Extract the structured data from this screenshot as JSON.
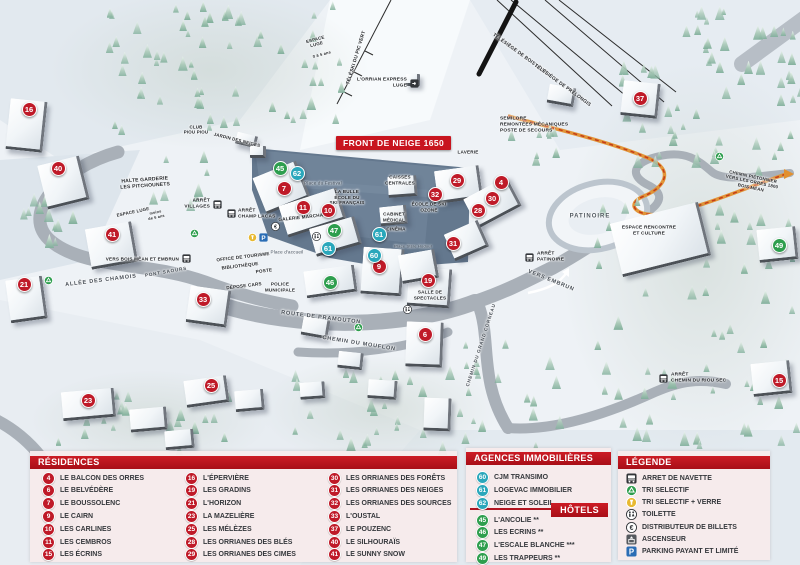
{
  "map": {
    "banner": "FRONT DE NEIGE 1650",
    "markers": [
      {
        "n": "16",
        "c": "r",
        "x": 28,
        "y": 108
      },
      {
        "n": "40",
        "c": "r",
        "x": 57,
        "y": 167
      },
      {
        "n": "41",
        "c": "r",
        "x": 111,
        "y": 233
      },
      {
        "n": "21",
        "c": "r",
        "x": 23,
        "y": 283
      },
      {
        "n": "23",
        "c": "r",
        "x": 87,
        "y": 399
      },
      {
        "n": "25",
        "c": "r",
        "x": 210,
        "y": 384
      },
      {
        "n": "33",
        "c": "r",
        "x": 202,
        "y": 298
      },
      {
        "n": "7",
        "c": "r",
        "x": 283,
        "y": 187
      },
      {
        "n": "11",
        "c": "r",
        "x": 302,
        "y": 206
      },
      {
        "n": "10",
        "c": "r",
        "x": 327,
        "y": 209
      },
      {
        "n": "9",
        "c": "r",
        "x": 378,
        "y": 265
      },
      {
        "n": "19",
        "c": "r",
        "x": 427,
        "y": 279
      },
      {
        "n": "6",
        "c": "r",
        "x": 424,
        "y": 333
      },
      {
        "n": "29",
        "c": "r",
        "x": 456,
        "y": 179
      },
      {
        "n": "32",
        "c": "r",
        "x": 434,
        "y": 193
      },
      {
        "n": "4",
        "c": "r",
        "x": 500,
        "y": 181
      },
      {
        "n": "30",
        "c": "r",
        "x": 491,
        "y": 197
      },
      {
        "n": "28",
        "c": "r",
        "x": 477,
        "y": 209
      },
      {
        "n": "31",
        "c": "r",
        "x": 452,
        "y": 242
      },
      {
        "n": "37",
        "c": "r",
        "x": 639,
        "y": 97
      },
      {
        "n": "15",
        "c": "r",
        "x": 778,
        "y": 379
      },
      {
        "n": "45",
        "c": "g",
        "x": 279,
        "y": 167
      },
      {
        "n": "47",
        "c": "g",
        "x": 333,
        "y": 229
      },
      {
        "n": "46",
        "c": "g",
        "x": 329,
        "y": 281
      },
      {
        "n": "49",
        "c": "g",
        "x": 778,
        "y": 244
      },
      {
        "n": "62",
        "c": "t",
        "x": 296,
        "y": 172
      },
      {
        "n": "61",
        "c": "t",
        "x": 378,
        "y": 233
      },
      {
        "n": "61",
        "c": "t",
        "x": 327,
        "y": 247
      },
      {
        "n": "60",
        "c": "t",
        "x": 373,
        "y": 254
      }
    ],
    "labels": [
      {
        "t": "L'ORRIAN EXPRESS\nLUGE",
        "x": 407,
        "y": 83,
        "al": "r",
        "fs": 4.8
      },
      {
        "t": "TÉLÉSKI DU PIC VERT",
        "x": 357,
        "y": 58,
        "r": -73,
        "fs": 4.8
      },
      {
        "t": "TÉLÉSIÈGE DE BOIS LONG",
        "x": 520,
        "y": 55,
        "r": 36,
        "fs": 4.8
      },
      {
        "t": "TÉLÉSIÈGE DE PRÉLONGIS",
        "x": 562,
        "y": 86,
        "r": 36,
        "fs": 4.8
      },
      {
        "t": "ESPACE\nLUGE",
        "x": 316,
        "y": 42,
        "r": -15,
        "fs": 4.4
      },
      {
        "t": "0 à 5 ans",
        "x": 322,
        "y": 55,
        "r": -15,
        "fs": 4
      },
      {
        "t": "SEMILORE\nREMONTÉES MÉCANIQUES\nPOSTE DE SECOURS",
        "x": 500,
        "y": 125,
        "al": "l",
        "fs": 4.8
      },
      {
        "t": "HALTE GARDERIE\nLES PITCHOUNETS",
        "x": 145,
        "y": 183,
        "r": -4
      },
      {
        "t": "CLUB\nPIOU PIOU",
        "x": 196,
        "y": 130,
        "fs": 4.4
      },
      {
        "t": "JARDIN DES NEIGES",
        "x": 237,
        "y": 140,
        "r": 14,
        "fs": 4.4
      },
      {
        "t": "ESPACE LUGE",
        "x": 133,
        "y": 212,
        "r": -12,
        "fs": 4.4
      },
      {
        "t": "moins\nde 6 ans",
        "x": 156,
        "y": 215,
        "r": -12,
        "fs": 3.8
      },
      {
        "t": "ARRÊT\nVILLAGES",
        "x": 210,
        "y": 204,
        "al": "r",
        "fs": 4.8
      },
      {
        "t": "ARRÊT\nCHAMP LACAS",
        "x": 238,
        "y": 214,
        "al": "l",
        "fs": 4.8
      },
      {
        "t": "Place du Festival",
        "x": 323,
        "y": 183,
        "cls": "place"
      },
      {
        "t": "LA BULLE\nÉCOLE DU\nSKI FRANÇAIS",
        "x": 347,
        "y": 197,
        "fs": 4.6
      },
      {
        "t": "GALERIE MARCHANDE",
        "x": 306,
        "y": 217,
        "r": -6,
        "fs": 4.6
      },
      {
        "t": "CAISSES\nCENTRALES",
        "x": 400,
        "y": 180,
        "fs": 4.6
      },
      {
        "t": "LAVERIE",
        "x": 468,
        "y": 152,
        "fs": 4.6
      },
      {
        "t": "ÉCOLE DE SKI\nOZONE",
        "x": 429,
        "y": 207,
        "fs": 4.6
      },
      {
        "t": "CABINET\nMÉDICAL",
        "x": 394,
        "y": 217,
        "fs": 4.6
      },
      {
        "t": "CINÉMA",
        "x": 396,
        "y": 229,
        "fs": 4.6
      },
      {
        "t": "Place Stèle Hodoul",
        "x": 413,
        "y": 247,
        "cls": "place",
        "fs": 4
      },
      {
        "t": "Place d'accueil",
        "x": 287,
        "y": 252,
        "cls": "place"
      },
      {
        "t": "OFFICE DE TOURISME",
        "x": 243,
        "y": 257,
        "r": -7,
        "fs": 4.6
      },
      {
        "t": "BIBLIOTHÈQUE",
        "x": 240,
        "y": 266,
        "r": -7,
        "fs": 4.6
      },
      {
        "t": "POSTE",
        "x": 264,
        "y": 271,
        "r": -7,
        "fs": 4.6
      },
      {
        "t": "DÉPOSE CARS",
        "x": 244,
        "y": 286,
        "r": -7,
        "fs": 4.6
      },
      {
        "t": "POLICE\nMUNICIPALE",
        "x": 280,
        "y": 287,
        "fs": 4.6
      },
      {
        "t": "ALLÉE DES CHAMOIS",
        "x": 101,
        "y": 281,
        "r": -7,
        "cls": "road"
      },
      {
        "t": "PONT SAOURS",
        "x": 166,
        "y": 272,
        "r": -10,
        "cls": "road",
        "fs": 4.6
      },
      {
        "t": "VERS BOIS MÉAN ET EMBRUN",
        "x": 179,
        "y": 259,
        "al": "r",
        "fs": 4.6
      },
      {
        "t": "ROUTE DE PRAMOUTON",
        "x": 321,
        "y": 318,
        "r": 7,
        "cls": "road"
      },
      {
        "t": "CHEMIN DU MOUFLON",
        "x": 359,
        "y": 344,
        "r": 9,
        "cls": "road"
      },
      {
        "t": "CHEMIN DU GRAND CORNEAU",
        "x": 481,
        "y": 345,
        "r": -72,
        "cls": "road",
        "fs": 4.6
      },
      {
        "t": "VERS EMBRUN",
        "x": 551,
        "y": 281,
        "r": 22,
        "cls": "road"
      },
      {
        "t": "SALLE DE\nSPECTACLES",
        "x": 430,
        "y": 295,
        "fs": 4.6
      },
      {
        "t": "PATINOIRE",
        "x": 590,
        "y": 217,
        "cls": "big"
      },
      {
        "t": "ESPACE RENCONTRE\nET CULTURE",
        "x": 649,
        "y": 231,
        "fs": 4.8
      },
      {
        "t": "ARRÊT\nPATINOIRE",
        "x": 537,
        "y": 257,
        "al": "l",
        "fs": 4.8
      },
      {
        "t": "ARRÊT\nCHEMIN DU RIOU SEC",
        "x": 671,
        "y": 378,
        "al": "l",
        "fs": 4.8
      },
      {
        "t": "CHEMIN PIÉTONNIER\nVERS LES ORRES 1800\nBOIS MÉAN",
        "x": 752,
        "y": 182,
        "r": 12,
        "fs": 4.4
      }
    ],
    "icons": [
      {
        "t": "bus",
        "x": 217,
        "y": 204
      },
      {
        "t": "bus",
        "x": 231,
        "y": 213
      },
      {
        "t": "bus",
        "x": 186,
        "y": 258
      },
      {
        "t": "bus",
        "x": 529,
        "y": 257
      },
      {
        "t": "bus",
        "x": 663,
        "y": 378
      },
      {
        "t": "recycle",
        "x": 194,
        "y": 233
      },
      {
        "t": "recycle",
        "x": 48,
        "y": 280
      },
      {
        "t": "recycle",
        "x": 358,
        "y": 327
      },
      {
        "t": "recycle",
        "x": 719,
        "y": 156
      },
      {
        "t": "glass",
        "x": 252,
        "y": 237
      },
      {
        "t": "parking",
        "x": 263,
        "y": 237
      },
      {
        "t": "euro",
        "x": 275,
        "y": 226
      },
      {
        "t": "toilet",
        "x": 316,
        "y": 236
      },
      {
        "t": "toilet",
        "x": 407,
        "y": 309
      },
      {
        "t": "box",
        "x": 414,
        "y": 83
      }
    ]
  },
  "legend": {
    "residences": {
      "title": "RÉSIDENCES",
      "items": [
        {
          "num": "4",
          "name": "LE BALCON DES ORRES"
        },
        {
          "num": "6",
          "name": "LE BELVÉDÈRE"
        },
        {
          "num": "7",
          "name": "LE BOUSSOLENC"
        },
        {
          "num": "9",
          "name": "LE CAIRN"
        },
        {
          "num": "10",
          "name": "LES CARLINES"
        },
        {
          "num": "11",
          "name": "LES CEMBROS"
        },
        {
          "num": "15",
          "name": "LES ÉCRINS"
        },
        {
          "num": "16",
          "name": "L'ÉPERVIÈRE"
        },
        {
          "num": "19",
          "name": "LES GRADINS"
        },
        {
          "num": "21",
          "name": "L'HORIZON"
        },
        {
          "num": "23",
          "name": "LA MAZELIÈRE"
        },
        {
          "num": "25",
          "name": "LES MÉLÈZES"
        },
        {
          "num": "28",
          "name": "LES ORRIANES DES BLÉS"
        },
        {
          "num": "29",
          "name": "LES ORRIANES DES CIMES"
        },
        {
          "num": "30",
          "name": "LES ORRIANES DES FORÊTS"
        },
        {
          "num": "31",
          "name": "LES ORRIANES DES NEIGES"
        },
        {
          "num": "32",
          "name": "LES ORRIANES DES SOURCES"
        },
        {
          "num": "33",
          "name": "L'OUSTAL"
        },
        {
          "num": "37",
          "name": "LE POUZENC"
        },
        {
          "num": "40",
          "name": "LE SILHOURAÏS"
        },
        {
          "num": "41",
          "name": "LE SUNNY SNOW"
        }
      ]
    },
    "agences": {
      "title": "AGENCES IMMOBILIÈRES",
      "items": [
        {
          "num": "60",
          "name": "CJM TRANSIMO"
        },
        {
          "num": "61",
          "name": "LOGEVAC IMMOBILIER"
        },
        {
          "num": "62",
          "name": "NEIGE ET SOLEIL"
        }
      ]
    },
    "hotels": {
      "title": "HÔTELS",
      "items": [
        {
          "num": "45",
          "name": "L'ANCOLIE **"
        },
        {
          "num": "46",
          "name": "LES ECRINS **"
        },
        {
          "num": "47",
          "name": "L'ESCALE BLANCHE ***"
        },
        {
          "num": "49",
          "name": "LES TRAPPEURS **"
        }
      ]
    },
    "legende": {
      "title": "LÉGENDE",
      "items": [
        {
          "icon": "bus",
          "label": "ARRET DE NAVETTE"
        },
        {
          "icon": "recycle",
          "label": "TRI SELECTIF"
        },
        {
          "icon": "glass",
          "label": "TRI SELECTIF + VERRE"
        },
        {
          "icon": "toilet",
          "label": "TOILETTE"
        },
        {
          "icon": "euro",
          "label": "DISTRIBUTEUR DE BILLETS"
        },
        {
          "icon": "lift",
          "label": "ASCENSEUR"
        },
        {
          "icon": "parking",
          "label": "PARKING PAYANT ET LIMITÉ"
        }
      ]
    }
  },
  "colors": {
    "header_red": "#b01420",
    "marker_red": "#bf1a28",
    "marker_green": "#2e9e4e",
    "marker_teal": "#2aa7bb",
    "banner_red": "#c8151f",
    "trail_orange": "#e2902e",
    "parking_blue": "#2a6db5",
    "glass_yellow": "#e8b931"
  }
}
